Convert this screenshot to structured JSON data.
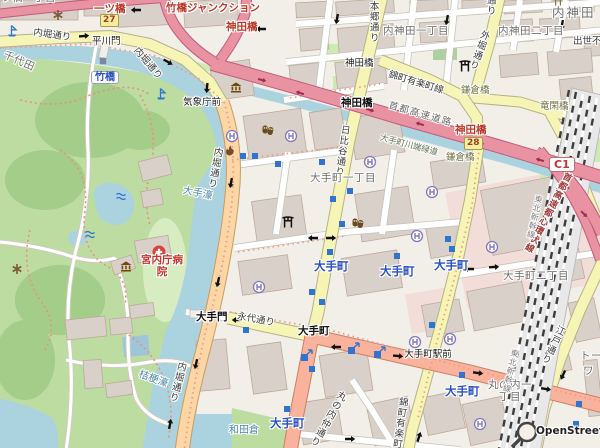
{
  "attribution": "OpenStreetMap",
  "colors": {
    "land": "#f2efe9",
    "water": "#aad3df",
    "park": "#bcdca2",
    "wood": "#a3cd89",
    "building": "#d9d0c9",
    "building_outline": "#bcab98",
    "motorway": "#e892a2",
    "trunk": "#f9b29c",
    "primary": "#fcd6a4",
    "secondary": "#f7f5b6",
    "retail_area": "#f2ddd8",
    "rail_dark": "#3d3d3d",
    "label_place": "#6d6d6d",
    "label_station": "#2a4fc0",
    "label_junction_red": "#bb3929",
    "label_water": "#4d87aa",
    "boundary_dash": "#ef9a8a",
    "icon_blue": "#2f74d0",
    "icon_purple": "#8478bd",
    "icon_brown": "#734a08",
    "hospital_red": "#d9433b"
  },
  "icon_legend": {
    "helipad-icon": "circled H",
    "subway-entrance-icon": "blue square",
    "subway-entrance-arrow-icon": "blue square with stair arrow",
    "museum-icon": "classical building",
    "torii-icon": "shrine torii",
    "hospital-icon": "red circle white cross",
    "fire-station-icon": "brown flame",
    "fountain-icon": "blue waves",
    "attraction-icon": "brown asterisk",
    "boat-icon": "blue flag",
    "station-icon": "grey square",
    "oneway-arrow-icon": "black arrow",
    "osm-logo": "magnifier"
  },
  "shields": [
    {
      "name": "route-shield-27",
      "ref": "27",
      "cls": "sh-y",
      "x": 100,
      "y": 14
    },
    {
      "name": "route-shield-28",
      "ref": "28",
      "cls": "sh-y",
      "x": 464,
      "y": 137
    },
    {
      "name": "route-shield-c1",
      "ref": "C1",
      "cls": "sh-c1",
      "x": 549,
      "y": 157
    }
  ],
  "labels": [
    {
      "name": "area-hitotsubashi-1chome",
      "t": "一ツ橋一丁目",
      "c": "place",
      "x": -10,
      "y": -7
    },
    {
      "name": "exit-hitotsubashi",
      "t": "一ツ橋",
      "c": "red",
      "x": 94,
      "y": 4
    },
    {
      "name": "jct-takebashi-junction",
      "t": "竹橋ジャンクション",
      "c": "red",
      "x": 166,
      "y": 3
    },
    {
      "name": "exit-kandabashi-north",
      "t": "神田橋",
      "c": "red",
      "x": 226,
      "y": 22
    },
    {
      "name": "road-uchibori-dori-nw",
      "t": "内堀通り",
      "c": "road",
      "x": 34,
      "y": 28,
      "r": 8
    },
    {
      "name": "gate-hirakawamon",
      "t": "平川門",
      "c": "jct",
      "x": 92,
      "y": 37
    },
    {
      "name": "area-chiyoda",
      "t": "千代田",
      "c": "place",
      "x": 6,
      "y": 50,
      "r": 24
    },
    {
      "name": "road-uchibori-dori-ne",
      "t": "内堀通り",
      "c": "road",
      "x": 139,
      "y": 46,
      "r": 50
    },
    {
      "name": "station-takebashi",
      "t": "竹橋",
      "c": "pill",
      "x": 91,
      "y": 71
    },
    {
      "name": "jct-kishochomae",
      "t": "気象庁前",
      "c": "jct",
      "x": 183,
      "y": 98
    },
    {
      "name": "road-hongo-dori",
      "t": "本郷通り",
      "c": "road vert",
      "x": 367,
      "y": 1
    },
    {
      "name": "area-uchikanda-1chome",
      "t": "内神田一丁目",
      "c": "place",
      "x": 383,
      "y": 26
    },
    {
      "name": "area-uchikanda-2chome",
      "t": "内神田二丁目",
      "c": "place",
      "x": 498,
      "y": 26
    },
    {
      "name": "area-uchikanda",
      "t": "内神田",
      "c": "place-lg",
      "x": 552,
      "y": 6
    },
    {
      "name": "road-shussefudo-dori",
      "t": "出世不動通り",
      "c": "road",
      "x": 573,
      "y": 37
    },
    {
      "name": "bridge-kandabashi",
      "t": "神田橋",
      "c": "jct",
      "x": 345,
      "y": 59
    },
    {
      "name": "jct-kandabashi",
      "t": "神田橋",
      "c": "jct-b",
      "x": 341,
      "y": 98
    },
    {
      "name": "road-nishikicho-yurakucho-line-n",
      "t": "錦町有楽町線",
      "c": "road",
      "x": 390,
      "y": 70,
      "r": 17
    },
    {
      "name": "bridge-kamakurabashi-n",
      "t": "鎌倉橋",
      "c": "bridge",
      "x": 461,
      "y": 86
    },
    {
      "name": "bridge-ryukanbashi",
      "t": "竜閑橋",
      "c": "bridge",
      "x": 540,
      "y": 102
    },
    {
      "name": "road-sotobori-dori",
      "t": "外堀通り",
      "c": "road vert",
      "x": 480,
      "y": 28,
      "r": 20
    },
    {
      "name": "road-sotobori-dori-top",
      "t": "外堀通り",
      "c": "road vert",
      "x": 484,
      "y": -26
    },
    {
      "name": "hwy-shuto-expressway",
      "t": "首都高速道路",
      "c": "hwy",
      "x": 390,
      "y": 101,
      "r": 16
    },
    {
      "name": "exit-kandabashi-south",
      "t": "神田橋",
      "c": "red",
      "x": 455,
      "y": 125
    },
    {
      "name": "path-otemachi-kawabata-ryokudo",
      "t": "大手町川端緑道",
      "c": "path-lbl",
      "x": 381,
      "y": 134,
      "r": 15
    },
    {
      "name": "bridge-kamakurabashi-s",
      "t": "鎌倉橋",
      "c": "bridge",
      "x": 446,
      "y": 153
    },
    {
      "name": "hwy-shuto-inner-circular",
      "t": "首都高速都心環状線",
      "c": "red-v vert",
      "x": 564,
      "y": 170,
      "r": 28
    },
    {
      "name": "road-hibiya-dori",
      "t": "日比谷通り",
      "c": "road vert",
      "x": 339,
      "y": 124,
      "r": 8
    },
    {
      "name": "area-otemachi-1chome",
      "t": "大手町一丁目",
      "c": "place",
      "x": 310,
      "y": 173
    },
    {
      "name": "water-otebori",
      "t": "大手濠",
      "c": "water",
      "x": 184,
      "y": 185,
      "r": 12
    },
    {
      "name": "road-uchibori-dori-c",
      "t": "内堀通り",
      "c": "road vert",
      "x": 212,
      "y": 146,
      "r": 10
    },
    {
      "name": "poi-kunaicho-hospital",
      "t": "宮内庁病院",
      "c": "hosp",
      "x": 138,
      "y": 255
    },
    {
      "name": "gate-otemon",
      "t": "大手門",
      "c": "jct-b",
      "x": 196,
      "y": 312
    },
    {
      "name": "road-eitai-dori",
      "t": "永代通り",
      "c": "road",
      "x": 238,
      "y": 312,
      "r": 10
    },
    {
      "name": "road-uchibori-dori-s",
      "t": "内堀通り",
      "c": "road vert",
      "x": 176,
      "y": 360,
      "r": 14
    },
    {
      "name": "water-kikyobori",
      "t": "桔梗濠",
      "c": "water",
      "x": 141,
      "y": 369,
      "r": 20
    },
    {
      "name": "water-wadakura",
      "t": "和田倉",
      "c": "water",
      "x": 229,
      "y": 425
    },
    {
      "name": "station-otemachi-1",
      "t": "大手町",
      "c": "sta",
      "x": 314,
      "y": 260
    },
    {
      "name": "station-otemachi-2",
      "t": "大手町",
      "c": "sta",
      "x": 380,
      "y": 265
    },
    {
      "name": "station-otemachi-3",
      "t": "大手町",
      "c": "sta",
      "x": 434,
      "y": 259
    },
    {
      "name": "station-otemachi-4",
      "t": "大手町",
      "c": "sta",
      "x": 445,
      "y": 385
    },
    {
      "name": "station-otemachi-5",
      "t": "大手町",
      "c": "sta",
      "x": 270,
      "y": 417
    },
    {
      "name": "jct-otemachi",
      "t": "大手町",
      "c": "jct-b",
      "x": 298,
      "y": 326
    },
    {
      "name": "jct-otemachi-ekimae",
      "t": "大手町駅前",
      "c": "jct wrap48",
      "x": 404,
      "y": 350
    },
    {
      "name": "area-otemachi-2chome",
      "t": "大手町二丁目",
      "c": "place",
      "x": 503,
      "y": 271
    },
    {
      "name": "area-marunouchi-1chome",
      "t": "丸の内一丁目",
      "c": "place wrap48",
      "x": 486,
      "y": 380
    },
    {
      "name": "road-marunouchi-naka-dori",
      "t": "丸の内仲通り",
      "c": "road vert",
      "x": 338,
      "y": 388,
      "r": 30
    },
    {
      "name": "road-nishikicho-yurakucho-line-s",
      "t": "錦町有楽町線",
      "c": "road vert",
      "x": 397,
      "y": 396,
      "r": 8
    },
    {
      "name": "road-edo-dori",
      "t": "江戸通り",
      "c": "road vert",
      "x": 556,
      "y": 323,
      "r": 26
    },
    {
      "name": "partial-label-to",
      "t": "トー",
      "c": "place",
      "x": 580,
      "y": 351
    },
    {
      "name": "partial-label-wa",
      "t": "ワ",
      "c": "place",
      "x": 583,
      "y": 366
    },
    {
      "name": "rail-tohoku-shinkansen-n",
      "t": "東北新幹線",
      "c": "rail vert",
      "x": 534,
      "y": 194,
      "r": 12
    },
    {
      "name": "rail-tohoku-shinkansen-s",
      "t": "東北新幹線",
      "c": "rail vert",
      "x": 510,
      "y": 348,
      "r": 12
    },
    {
      "name": "osm-attribution",
      "t": "OpenStreetMap",
      "c": "attr",
      "x": 536,
      "y": 426,
      "i": true
    }
  ],
  "buildings": [
    [
      296,
      2,
      32,
      15,
      -3
    ],
    [
      336,
      0,
      58,
      14,
      -4
    ],
    [
      410,
      0,
      38,
      11,
      -3
    ],
    [
      462,
      0,
      30,
      11,
      -3
    ],
    [
      504,
      0,
      38,
      13,
      -3
    ],
    [
      552,
      0,
      42,
      12,
      -2
    ],
    [
      300,
      28,
      28,
      22,
      -5
    ],
    [
      338,
      26,
      56,
      25,
      -5
    ],
    [
      420,
      22,
      26,
      20,
      -4
    ],
    [
      497,
      20,
      36,
      22,
      -4
    ],
    [
      540,
      18,
      40,
      20,
      -3
    ],
    [
      584,
      30,
      16,
      26,
      -3
    ],
    [
      290,
      64,
      32,
      24,
      -6
    ],
    [
      336,
      60,
      50,
      26,
      -6
    ],
    [
      500,
      54,
      38,
      22,
      -5
    ],
    [
      548,
      50,
      44,
      24,
      -5
    ],
    [
      560,
      78,
      32,
      20,
      -6
    ],
    [
      212,
      62,
      40,
      36,
      -8
    ],
    [
      118,
      2,
      50,
      24,
      -3
    ],
    [
      184,
      0,
      54,
      26,
      -4
    ],
    [
      0,
      0,
      78,
      20,
      0
    ],
    [
      84,
      0,
      28,
      16,
      0
    ],
    [
      246,
      112,
      58,
      46,
      -8
    ],
    [
      312,
      110,
      32,
      38,
      -9
    ],
    [
      352,
      114,
      50,
      42,
      -9
    ],
    [
      254,
      198,
      50,
      40,
      -8
    ],
    [
      240,
      258,
      50,
      34,
      -8
    ],
    [
      358,
      190,
      54,
      48,
      -9
    ],
    [
      344,
      254,
      56,
      38,
      -9
    ],
    [
      432,
      158,
      52,
      28,
      -9
    ],
    [
      486,
      182,
      84,
      66,
      -11
    ],
    [
      470,
      286,
      56,
      40,
      -11
    ],
    [
      530,
      332,
      38,
      42,
      -12
    ],
    [
      428,
      224,
      32,
      32,
      -10
    ],
    [
      424,
      302,
      38,
      32,
      -10
    ],
    [
      546,
      252,
      36,
      30,
      -12
    ],
    [
      198,
      340,
      30,
      50,
      -5
    ],
    [
      250,
      344,
      34,
      48,
      -8
    ],
    [
      322,
      352,
      48,
      42,
      -9
    ],
    [
      300,
      400,
      40,
      42,
      -9
    ],
    [
      370,
      400,
      42,
      42,
      -12
    ],
    [
      424,
      394,
      38,
      38,
      -12
    ],
    [
      466,
      400,
      40,
      42,
      -12
    ],
    [
      572,
      300,
      26,
      40,
      -12
    ],
    [
      586,
      360,
      14,
      56,
      -6
    ],
    [
      140,
      158,
      30,
      20,
      -14
    ],
    [
      142,
      190,
      20,
      16,
      -10
    ],
    [
      136,
      238,
      34,
      22,
      -10
    ],
    [
      112,
      258,
      22,
      14,
      -18
    ],
    [
      66,
      318,
      40,
      20,
      -6
    ],
    [
      110,
      318,
      22,
      16,
      -6
    ],
    [
      130,
      304,
      24,
      13,
      -8
    ],
    [
      84,
      360,
      18,
      28,
      -4
    ],
    [
      106,
      382,
      26,
      14,
      -8
    ]
  ],
  "icons": [
    {
      "type": "helipad",
      "pts": [
        [
          232,
          136
        ],
        [
          291,
          136
        ],
        [
          370,
          162
        ],
        [
          432,
          192
        ],
        [
          417,
          236
        ],
        [
          492,
          247
        ],
        [
          259,
          287
        ],
        [
          415,
          342
        ],
        [
          450,
          339
        ],
        [
          480,
          424
        ]
      ]
    },
    {
      "type": "entrance",
      "pts": [
        [
          255,
          156
        ],
        [
          278,
          164
        ],
        [
          322,
          162
        ],
        [
          350,
          191
        ],
        [
          333,
          199
        ],
        [
          342,
          224
        ],
        [
          330,
          252
        ],
        [
          397,
          256
        ],
        [
          448,
          239
        ],
        [
          452,
          249
        ],
        [
          312,
          292
        ],
        [
          322,
          302
        ],
        [
          312,
          369
        ],
        [
          432,
          325
        ],
        [
          462,
          375
        ],
        [
          579,
          404
        ],
        [
          576,
          424
        ],
        [
          246,
          330
        ],
        [
          287,
          409
        ],
        [
          243,
          156
        ]
      ]
    },
    {
      "type": "entarrow",
      "pts": [
        [
          352,
          349
        ],
        [
          378,
          353
        ],
        [
          305,
          356
        ]
      ]
    },
    {
      "type": "museum",
      "pts": [
        [
          236,
          88
        ],
        [
          126,
          267
        ]
      ]
    },
    {
      "type": "torii",
      "pts": [
        [
          465,
          66
        ],
        [
          288,
          222
        ]
      ]
    },
    {
      "type": "shrinesm",
      "pts": [
        [
          558,
          2
        ]
      ]
    },
    {
      "type": "masks",
      "pts": [
        [
          268,
          130
        ],
        [
          358,
          223
        ]
      ]
    },
    {
      "type": "fire",
      "pts": [
        [
          230,
          151
        ]
      ]
    },
    {
      "type": "hospital",
      "pts": [
        [
          159,
          252
        ]
      ]
    },
    {
      "type": "fountain",
      "pts": [
        [
          121,
          196
        ],
        [
          90,
          234
        ]
      ]
    },
    {
      "type": "asterisk",
      "pts": [
        [
          58,
          15
        ],
        [
          17,
          269
        ]
      ]
    },
    {
      "type": "boat",
      "pts": [
        [
          12,
          31
        ],
        [
          161,
          94
        ]
      ]
    },
    {
      "type": "stationsq",
      "pts": [
        [
          103,
          61
        ]
      ]
    }
  ],
  "oneway_arrows": [
    [
      136,
      10,
      180
    ],
    [
      84,
      36,
      -5
    ],
    [
      168,
      62,
      30
    ],
    [
      207,
      88,
      95
    ],
    [
      261,
      29,
      180
    ],
    [
      337,
      19,
      100
    ],
    [
      447,
      20,
      100
    ],
    [
      562,
      25,
      100
    ],
    [
      231,
      183,
      100
    ],
    [
      218,
      282,
      103
    ],
    [
      196,
      364,
      103
    ],
    [
      170,
      424,
      -80
    ],
    [
      237,
      320,
      180
    ],
    [
      313,
      238,
      180
    ],
    [
      331,
      238,
      0
    ],
    [
      350,
      439,
      0
    ],
    [
      336,
      347,
      180
    ],
    [
      398,
      356,
      5
    ],
    [
      478,
      373,
      8
    ],
    [
      546,
      389,
      10
    ],
    [
      469,
      269,
      180
    ],
    [
      494,
      267,
      -3
    ],
    [
      563,
      375,
      115
    ],
    [
      419,
      437,
      -72
    ]
  ],
  "highway_arrows": [
    [
      262,
      80,
      14
    ],
    [
      300,
      93,
      196
    ],
    [
      370,
      110,
      15
    ],
    [
      420,
      124,
      197
    ],
    [
      480,
      143,
      15
    ],
    [
      540,
      160,
      196
    ],
    [
      566,
      186,
      40
    ],
    [
      584,
      214,
      45
    ]
  ]
}
